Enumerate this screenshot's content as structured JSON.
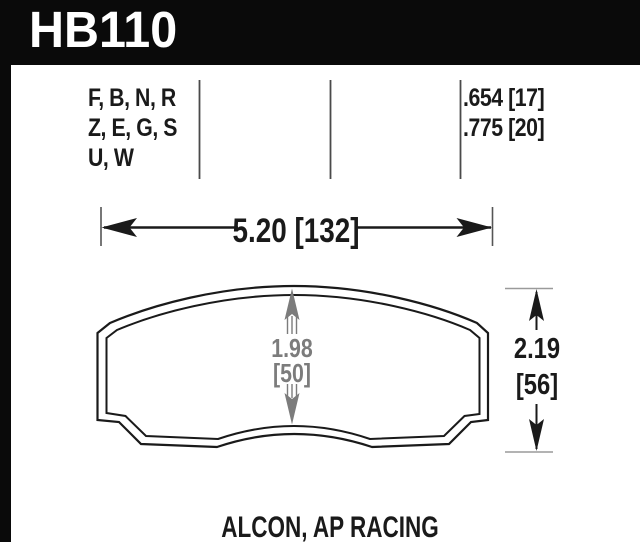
{
  "header": {
    "part_number": "HB110"
  },
  "spec_row": {
    "compound_codes": [
      "F, B, N, R",
      "Z, E, G, S",
      "U, W"
    ],
    "pad_thickness": [
      ".654 [17]",
      ".775 [20]"
    ]
  },
  "dimensions": {
    "overall_width": "5.20 [132]",
    "center_height_in": "1.98",
    "center_height_mm": "[50]",
    "overall_height_in": "2.19",
    "overall_height_mm": "[56]"
  },
  "footer": {
    "applications": "ALCON, AP RACING"
  },
  "colors": {
    "frame_black": "#0a0a0a",
    "ink_black": "#1a1a1a",
    "dimension_gray": "#7c7c7c",
    "divider_gray": "#4a4a4a",
    "background": "#ffffff"
  }
}
